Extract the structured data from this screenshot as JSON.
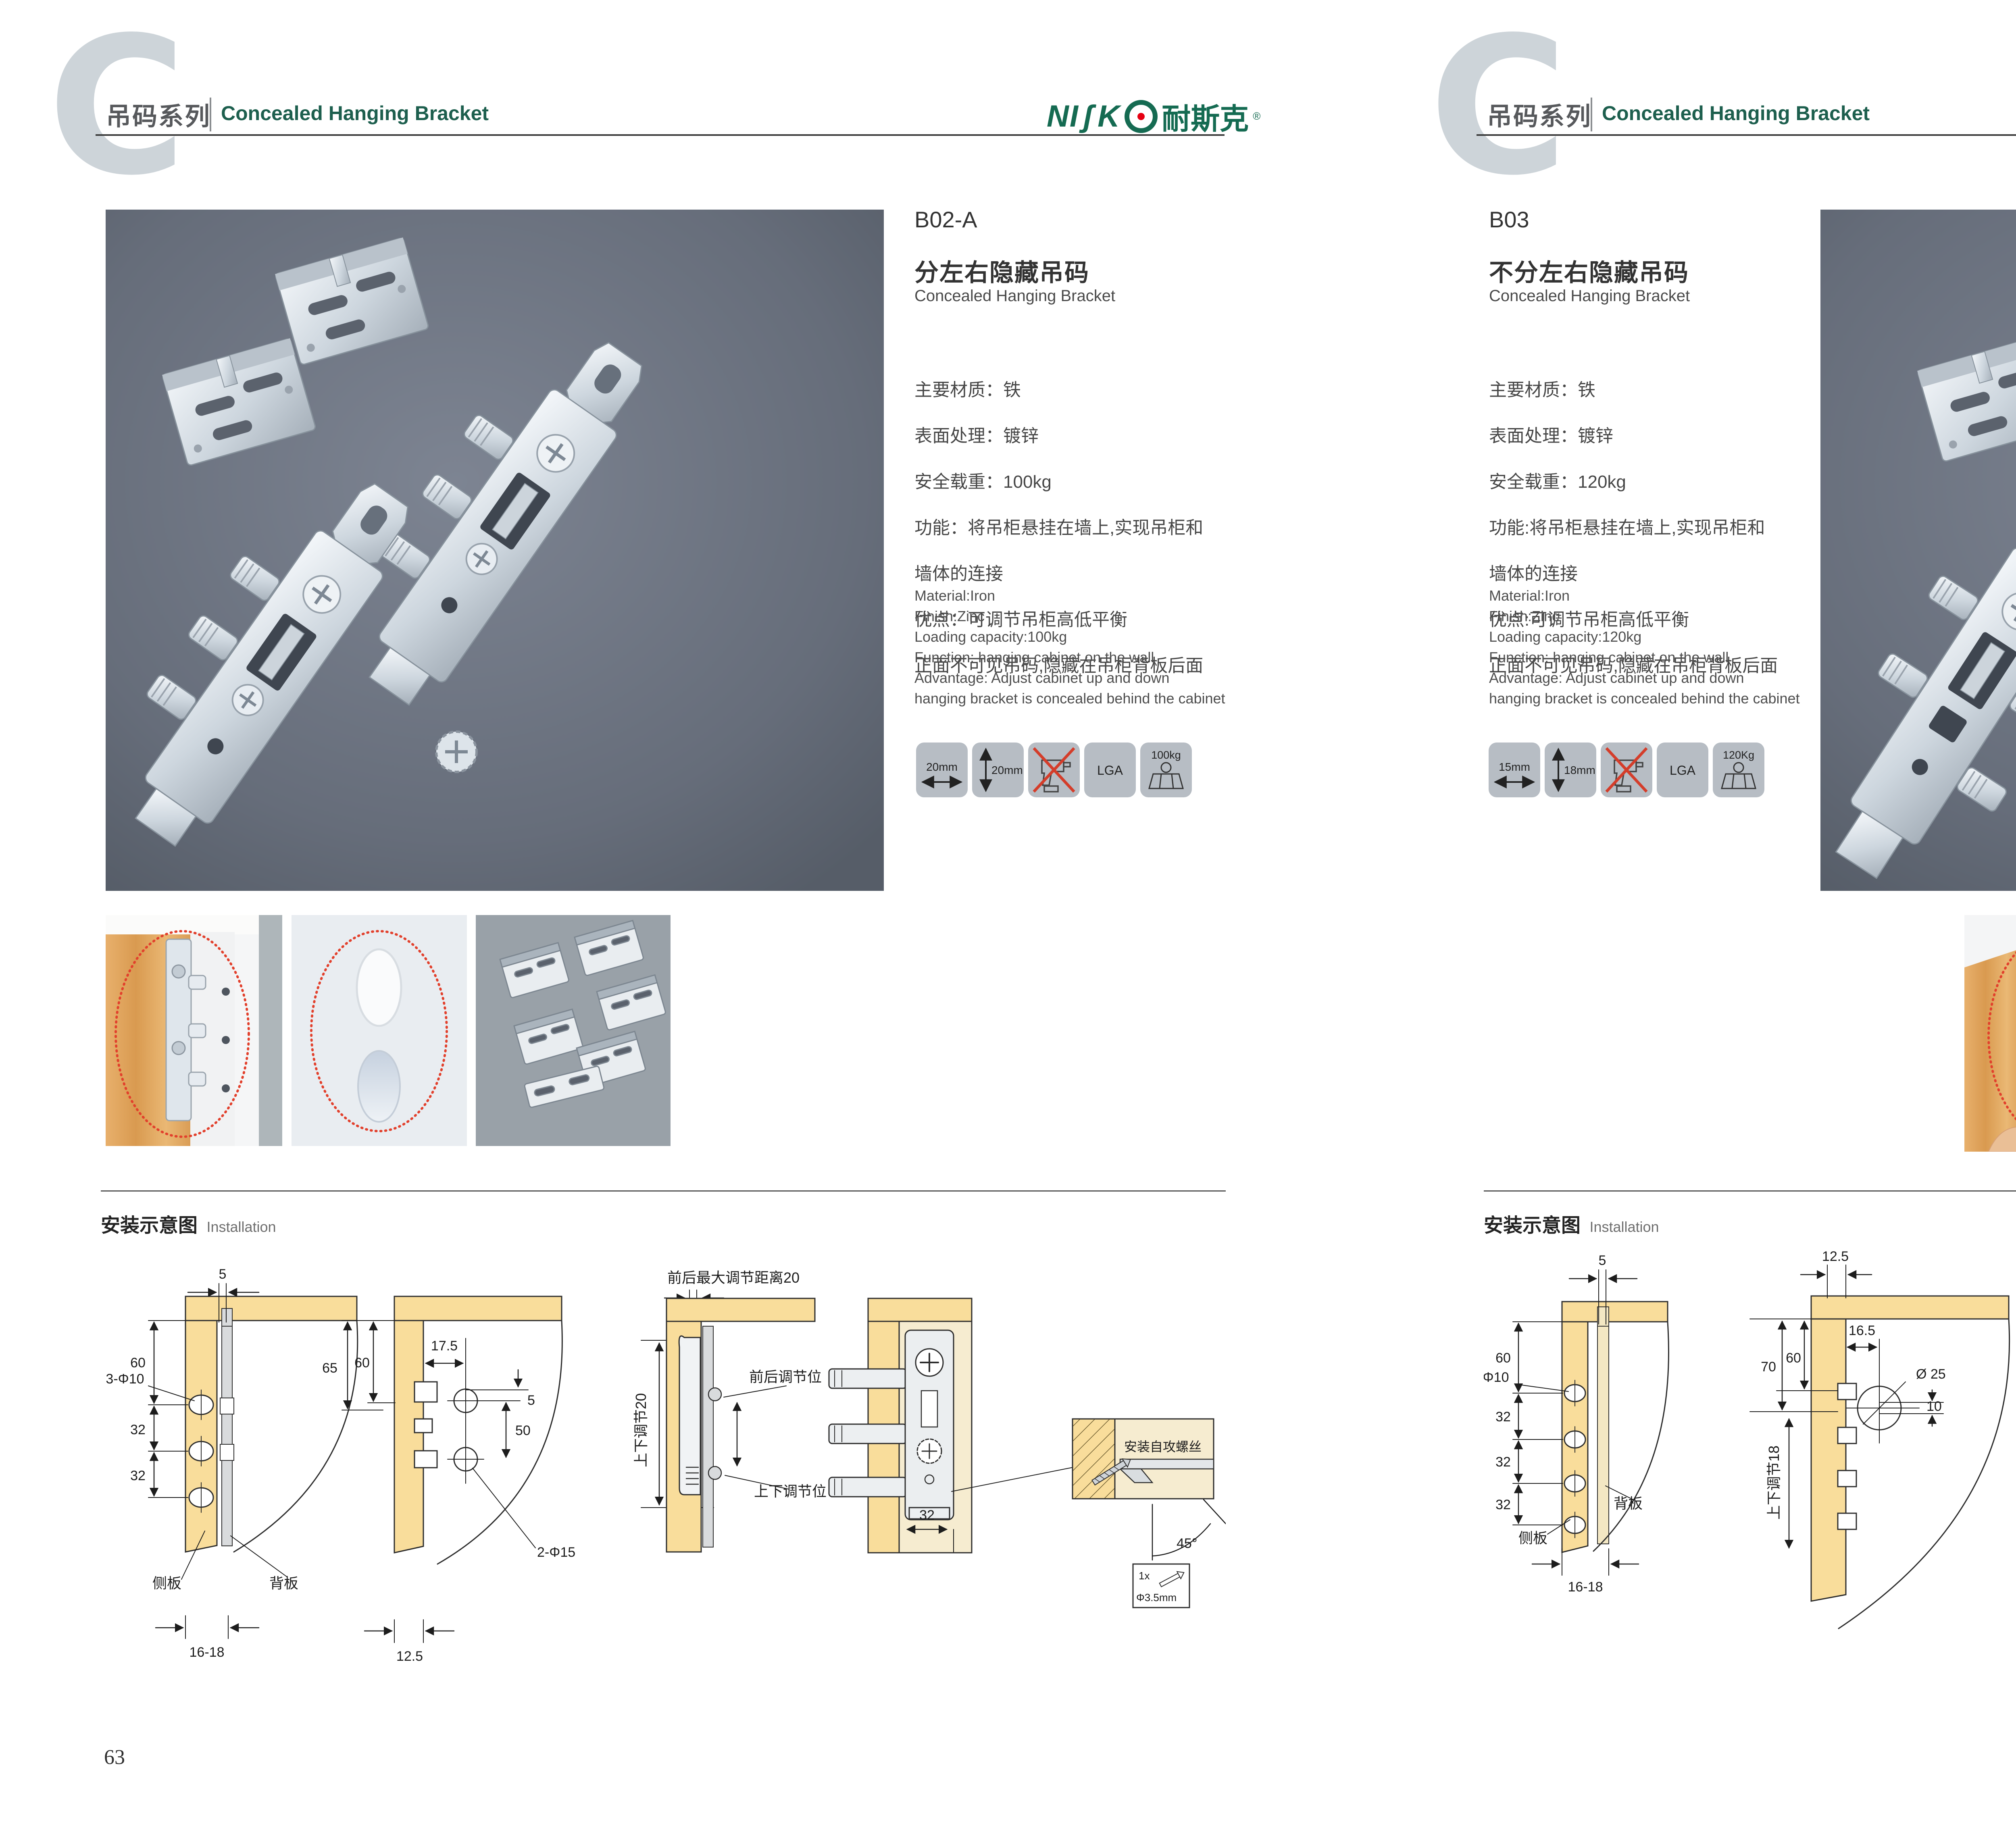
{
  "header": {
    "series_cn": "吊码系列",
    "series_en": "Concealed Hanging Bracket"
  },
  "brand": {
    "ni": "NI",
    "s": "ʃ",
    "k": "K",
    "cn": "耐斯克",
    "reg": "®"
  },
  "installation": {
    "title_cn": "安装示意图",
    "title_en": "Installation"
  },
  "colors": {
    "brand_green": "#156b52",
    "accent_red": "#e60012",
    "diagram_tan": "#f9dd9b"
  },
  "left": {
    "page_number": "63",
    "product": {
      "code": "B02-A",
      "name_cn": "分左右隐藏吊码",
      "name_en": "Concealed Hanging Bracket",
      "specs_cn": [
        "主要材质：铁",
        "表面处理：镀锌",
        "安全载重：100kg",
        "功能：将吊柜悬挂在墙上,实现吊柜和",
        "墙体的连接",
        "优点：可调节吊柜高低平衡",
        "正面不可见吊码,隐藏在吊柜背板后面"
      ],
      "specs_en": [
        "Material:Iron",
        "Finish:Zinc",
        "Loading capacity:100kg",
        "Function: hanging cabinet on the wall",
        "Advantage: Adjust cabinet up and down",
        "hanging bracket is concealed behind the cabinet"
      ],
      "icons": {
        "width": "20mm",
        "height": "20mm",
        "cert": "LGA",
        "load": "100kg"
      }
    },
    "diagram": {
      "d1": {
        "top": "5",
        "v60": "60",
        "hole": "3-Φ10",
        "a32": "32",
        "b32": "32",
        "side": "侧板",
        "back": "背板",
        "bottom": "16-18"
      },
      "d2": {
        "h175": "17.5",
        "v65": "65",
        "v60": "60",
        "d5": "5",
        "v50": "50",
        "hole": "2-Φ15",
        "bottom": "12.5",
        "updown": "上下调节20"
      },
      "d3": {
        "top": "前后最大调节距离20",
        "front_pos": "前后调节位",
        "ud_pos": "上下调节位"
      },
      "d4": {
        "w32": "32"
      },
      "detail": {
        "label": "安装自攻螺丝",
        "angle": "45°",
        "qty": "1x",
        "dia": "Φ3.5mm"
      }
    }
  },
  "right": {
    "page_number": "64",
    "product": {
      "code": "B03",
      "name_cn": "不分左右隐藏吊码",
      "name_en": "Concealed Hanging Bracket",
      "specs_cn": [
        "主要材质：铁",
        "表面处理：镀锌",
        "安全载重：120kg",
        "功能:将吊柜悬挂在墙上,实现吊柜和",
        "墙体的连接",
        "优点:可调节吊柜高低平衡",
        "正面不可见吊码,隐藏在吊柜背板后面"
      ],
      "specs_en": [
        "Material:Iron",
        "Finish:Zinc",
        "Loading capacity:120kg",
        "Function: hanging cabinet on the wall",
        "Advantage: Adjust cabinet up and down",
        "hanging bracket is concealed behind the cabinet"
      ],
      "icons": {
        "width": "15mm",
        "height": "18mm",
        "cert": "LGA",
        "load": "120Kg"
      }
    },
    "diagram": {
      "d1": {
        "top": "5",
        "v60": "60",
        "hole": "Φ10",
        "a32": "32",
        "b32": "32",
        "c32": "32",
        "side": "侧板",
        "back": "背板",
        "bottom": "16-18"
      },
      "d2": {
        "top": "12.5",
        "v70": "70",
        "v60": "60",
        "h165": "16.5",
        "hole": "Ø 25",
        "off": "10",
        "updown": "上下调节18"
      },
      "d3": {
        "top": "16.5",
        "l125": "12.5",
        "l10": "10",
        "hole": "ø25",
        "lock": "锁紧状态"
      },
      "detail": {
        "label": "安装自攻螺丝",
        "angle": "45°",
        "qty": "1x",
        "dia": "Φ3.5mm"
      }
    }
  }
}
